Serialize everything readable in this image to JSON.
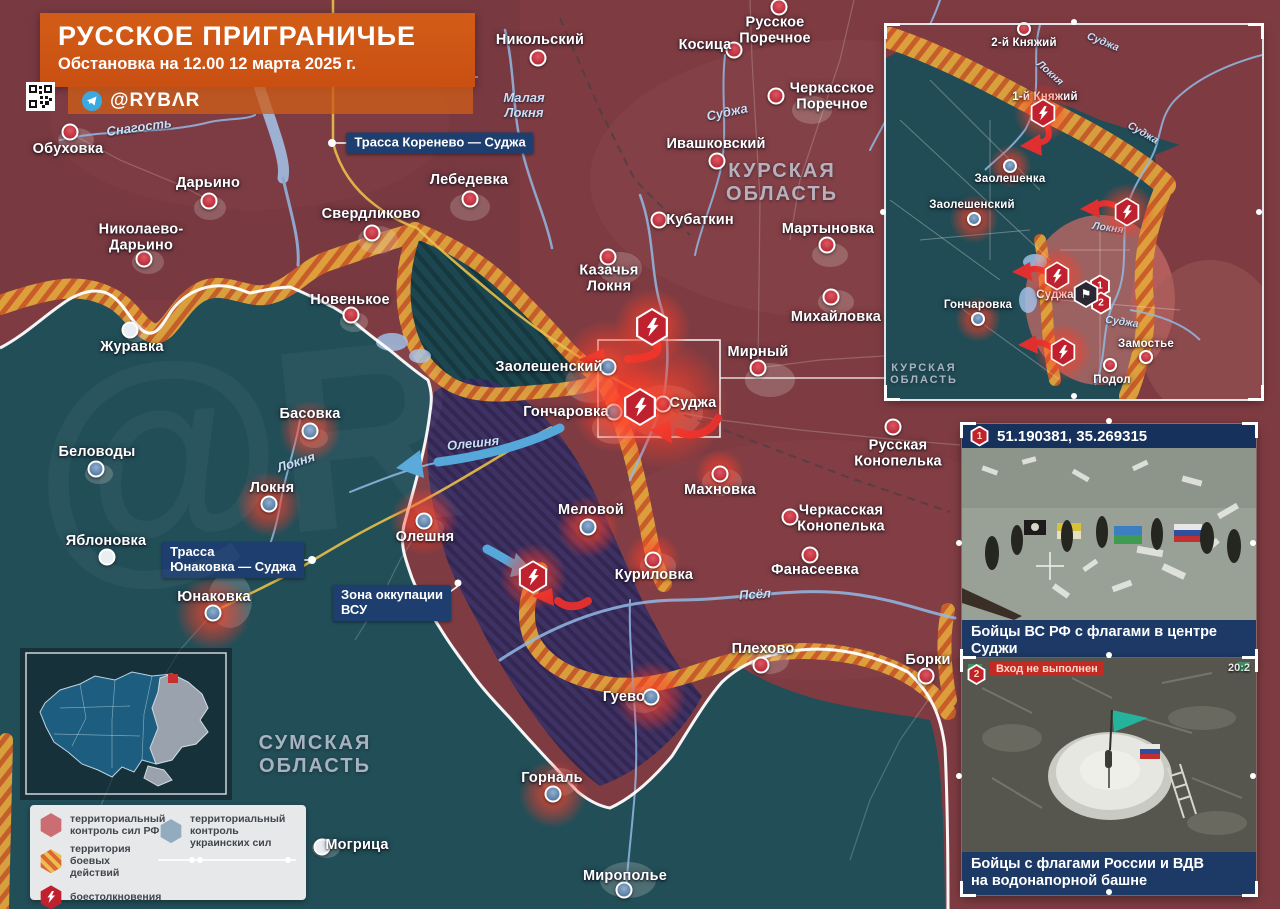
{
  "title": {
    "heading": "РУССКОЕ ПРИГРАНИЧЬЕ",
    "subtitle": "Обстановка на 12.00 12 марта 2025 г.",
    "telegram_handle": "@RYBΛR"
  },
  "colors": {
    "rf_control": "#7e3c42",
    "ua_control": "#224e58",
    "vsu_zone": "#3a3066",
    "combat_band_base": "#e2a33c",
    "combat_band_stripe": "#cc5f28",
    "banner_orange": "#cd5514",
    "info_box_blue": "#1d3e6e",
    "caption_navy": "#1d3a66",
    "clash_red": "#c0212e"
  },
  "region_labels": [
    {
      "text": "КУРСКАЯ\nОБЛАСТЬ",
      "x": 782,
      "y": 183,
      "fs": 20
    },
    {
      "text": "СУМСКАЯ\nОБЛАСТЬ",
      "x": 315,
      "y": 755,
      "fs": 20
    },
    {
      "text": "КУРСКАЯ\nОБЛАСТЬ",
      "x": 924,
      "y": 374,
      "fs": 11
    }
  ],
  "info_boxes": [
    {
      "text": "Трасса Коренево — Суджа",
      "x": 440,
      "y": 143
    },
    {
      "text": "Трасса\nЮнаковка — Суджа",
      "x": 233,
      "y": 560
    },
    {
      "text": "Зона оккупации\nВСУ",
      "x": 392,
      "y": 603
    }
  ],
  "river_labels": [
    {
      "text": "Снагость",
      "x": 139,
      "y": 127,
      "r": -8
    },
    {
      "text": "Малая\nЛокня",
      "x": 524,
      "y": 105,
      "r": 0
    },
    {
      "text": "Суджа",
      "x": 727,
      "y": 112,
      "r": -12
    },
    {
      "text": "Олешня",
      "x": 473,
      "y": 443,
      "r": -6
    },
    {
      "text": "Локня",
      "x": 296,
      "y": 462,
      "r": -18
    },
    {
      "text": "Псёл",
      "x": 755,
      "y": 594,
      "r": -4
    },
    {
      "text": "Локня",
      "x": 1050,
      "y": 73,
      "r": 42,
      "sm": true
    },
    {
      "text": "Суджа",
      "x": 1103,
      "y": 42,
      "r": 22,
      "sm": true
    },
    {
      "text": "Суджа",
      "x": 1143,
      "y": 133,
      "r": 30,
      "sm": true
    },
    {
      "text": "Локня",
      "x": 1108,
      "y": 228,
      "r": 8,
      "sm": true
    },
    {
      "text": "Суджа",
      "x": 1122,
      "y": 322,
      "r": 8,
      "sm": true
    }
  ],
  "settlements": [
    {
      "name": "Обуховка",
      "lx": 68,
      "ly": 150,
      "mx": 70,
      "my": 132,
      "c": "ru"
    },
    {
      "name": "Дарьино",
      "lx": 208,
      "ly": 184,
      "mx": 209,
      "my": 201,
      "c": "ru"
    },
    {
      "name": "Николаево-\nДарьино",
      "lx": 141,
      "ly": 238,
      "mx": 144,
      "my": 259,
      "c": "ru"
    },
    {
      "name": "Свердликово",
      "lx": 371,
      "ly": 215,
      "mx": 372,
      "my": 233,
      "c": "ru"
    },
    {
      "name": "Лебедевка",
      "lx": 469,
      "ly": 181,
      "mx": 470,
      "my": 199,
      "c": "ru"
    },
    {
      "name": "Никольский",
      "lx": 540,
      "ly": 41,
      "mx": 538,
      "my": 58,
      "c": "ru"
    },
    {
      "name": "Косица",
      "lx": 705,
      "ly": 46,
      "mx": 734,
      "my": 50,
      "c": "ru"
    },
    {
      "name": "Русское\nПоречное",
      "lx": 775,
      "ly": 31,
      "mx": 779,
      "my": 7,
      "c": "ru"
    },
    {
      "name": "Черкасское\nПоречное",
      "lx": 832,
      "ly": 97,
      "mx": 776,
      "my": 96,
      "c": "ru"
    },
    {
      "name": "Ивашковский",
      "lx": 716,
      "ly": 145,
      "mx": 717,
      "my": 161,
      "c": "ru"
    },
    {
      "name": "Кубаткин",
      "lx": 700,
      "ly": 221,
      "mx": 659,
      "my": 220,
      "c": "ru"
    },
    {
      "name": "Мартыновка",
      "lx": 828,
      "ly": 230,
      "mx": 827,
      "my": 245,
      "c": "ru"
    },
    {
      "name": "Михайловка",
      "lx": 836,
      "ly": 318,
      "mx": 831,
      "my": 297,
      "c": "ru"
    },
    {
      "name": "Казачья\nЛокня",
      "lx": 609,
      "ly": 279,
      "mx": 608,
      "my": 257,
      "c": "ru"
    },
    {
      "name": "Мирный",
      "lx": 758,
      "ly": 353,
      "mx": 758,
      "my": 368,
      "c": "ru"
    },
    {
      "name": "Новенькое",
      "lx": 350,
      "ly": 301,
      "mx": 351,
      "my": 315,
      "c": "ru"
    },
    {
      "name": "Журавка",
      "lx": 132,
      "ly": 348,
      "mx": 130,
      "my": 330,
      "c": "n"
    },
    {
      "name": "Басовка",
      "lx": 310,
      "ly": 415,
      "mx": 310,
      "my": 431,
      "c": "ua",
      "g": 38
    },
    {
      "name": "Беловоды",
      "lx": 97,
      "ly": 453,
      "mx": 96,
      "my": 469,
      "c": "ua"
    },
    {
      "name": "Локня",
      "lx": 272,
      "ly": 489,
      "mx": 269,
      "my": 504,
      "c": "ua",
      "g": 40
    },
    {
      "name": "Яблоновка",
      "lx": 106,
      "ly": 542,
      "mx": 107,
      "my": 557,
      "c": "n"
    },
    {
      "name": "Юнаковка",
      "lx": 214,
      "ly": 598,
      "mx": 213,
      "my": 613,
      "c": "ua",
      "g": 46
    },
    {
      "name": "Олешня",
      "lx": 425,
      "ly": 538,
      "mx": 424,
      "my": 521,
      "c": "ua",
      "g": 42
    },
    {
      "name": "Заолешенский",
      "lx": 549,
      "ly": 368,
      "mx": 608,
      "my": 367,
      "c": "ua",
      "g": 58
    },
    {
      "name": "Гончаровка",
      "lx": 566,
      "ly": 413,
      "mx": 614,
      "my": 412,
      "c": "ua",
      "g": 50
    },
    {
      "name": "Суджа",
      "lx": 693,
      "ly": 404,
      "mx": 663,
      "my": 404,
      "c": "ru",
      "g": 80
    },
    {
      "name": "Меловой",
      "lx": 591,
      "ly": 511,
      "mx": 588,
      "my": 527,
      "c": "ua",
      "g": 38
    },
    {
      "name": "Махновка",
      "lx": 720,
      "ly": 491,
      "mx": 720,
      "my": 474,
      "c": "ru",
      "g": 30
    },
    {
      "name": "Черкасская\nКонопелька",
      "lx": 841,
      "ly": 519,
      "mx": 790,
      "my": 517,
      "c": "ru"
    },
    {
      "name": "Русская\nКонопелька",
      "lx": 898,
      "ly": 454,
      "mx": 893,
      "my": 427,
      "c": "ru"
    },
    {
      "name": "Фанасеевка",
      "lx": 815,
      "ly": 571,
      "mx": 810,
      "my": 555,
      "c": "ru"
    },
    {
      "name": "Куриловка",
      "lx": 654,
      "ly": 576,
      "mx": 653,
      "my": 560,
      "c": "ru",
      "g": 34
    },
    {
      "name": "Плехово",
      "lx": 763,
      "ly": 650,
      "mx": 761,
      "my": 665,
      "c": "ru"
    },
    {
      "name": "Борки",
      "lx": 928,
      "ly": 661,
      "mx": 926,
      "my": 676,
      "c": "ru"
    },
    {
      "name": "Гуево",
      "lx": 624,
      "ly": 698,
      "mx": 651,
      "my": 697,
      "c": "ua",
      "g": 44
    },
    {
      "name": "Горналь",
      "lx": 552,
      "ly": 779,
      "mx": 553,
      "my": 794,
      "c": "ua",
      "g": 42
    },
    {
      "name": "Могрица",
      "lx": 357,
      "ly": 846,
      "mx": 322,
      "my": 847,
      "c": "n"
    },
    {
      "name": "Мирополье",
      "lx": 625,
      "ly": 877,
      "mx": 624,
      "my": 890,
      "c": "ua"
    }
  ],
  "inset": {
    "settlements": [
      {
        "name": "2-й Княжий",
        "lx": 1024,
        "ly": 43,
        "mx": 1024,
        "my": 29,
        "c": "ru",
        "sm": true
      },
      {
        "name": "1-й Княжий",
        "lx": 1045,
        "ly": 97,
        "c": "ru",
        "sm": true
      },
      {
        "name": "Заолешенка",
        "lx": 1010,
        "ly": 179,
        "mx": 1010,
        "my": 166,
        "c": "ua",
        "g": 26,
        "sm": true
      },
      {
        "name": "Заолешенский",
        "lx": 972,
        "ly": 205,
        "mx": 974,
        "my": 219,
        "c": "ua",
        "g": 30,
        "sm": true
      },
      {
        "name": "Гончаровка",
        "lx": 978,
        "ly": 305,
        "mx": 978,
        "my": 319,
        "c": "ua",
        "g": 28,
        "sm": true
      },
      {
        "name": "Суджа",
        "lx": 1055,
        "ly": 295,
        "sm": true
      },
      {
        "name": "Замостье",
        "lx": 1146,
        "ly": 344,
        "mx": 1146,
        "my": 357,
        "c": "ru",
        "sm": true
      },
      {
        "name": "Подол",
        "lx": 1112,
        "ly": 380,
        "mx": 1110,
        "my": 365,
        "c": "ru",
        "sm": true
      }
    ],
    "photo_refs": [
      {
        "num": "1",
        "x": 1100,
        "y": 286
      },
      {
        "num": "2",
        "x": 1101,
        "y": 303
      }
    ],
    "flag_marker": {
      "x": 1086,
      "y": 294,
      "glyph": "⚑"
    }
  },
  "clashes": [
    {
      "x": 652,
      "y": 327,
      "s": 34
    },
    {
      "x": 640,
      "y": 407,
      "s": 34
    },
    {
      "x": 533,
      "y": 577,
      "s": 30
    },
    {
      "x": 1043,
      "y": 113,
      "s": 26
    },
    {
      "x": 1127,
      "y": 212,
      "s": 26
    },
    {
      "x": 1057,
      "y": 276,
      "s": 26
    },
    {
      "x": 1063,
      "y": 352,
      "s": 26
    }
  ],
  "photos": [
    {
      "num": "1",
      "header": "51.190381, 35.269315",
      "caption": "Бойцы ВС РФ с флагами в центре Суджи"
    },
    {
      "num": "2",
      "overlay": "Вход не выполнен",
      "time": "20:2",
      "caption": "Бойцы с флагами России и ВДВ\nна водонапорной башне"
    }
  ],
  "legend": {
    "items": [
      {
        "icon": "hex-red",
        "label": "территориальный\nконтроль сил РФ"
      },
      {
        "icon": "hex-striped",
        "label": "территория\nбоевых действий"
      },
      {
        "icon": "hex-bolt",
        "label": "боестолкновения"
      },
      {
        "icon": "hex-blue",
        "label": "территориальный\nконтроль украинских сил"
      }
    ]
  }
}
